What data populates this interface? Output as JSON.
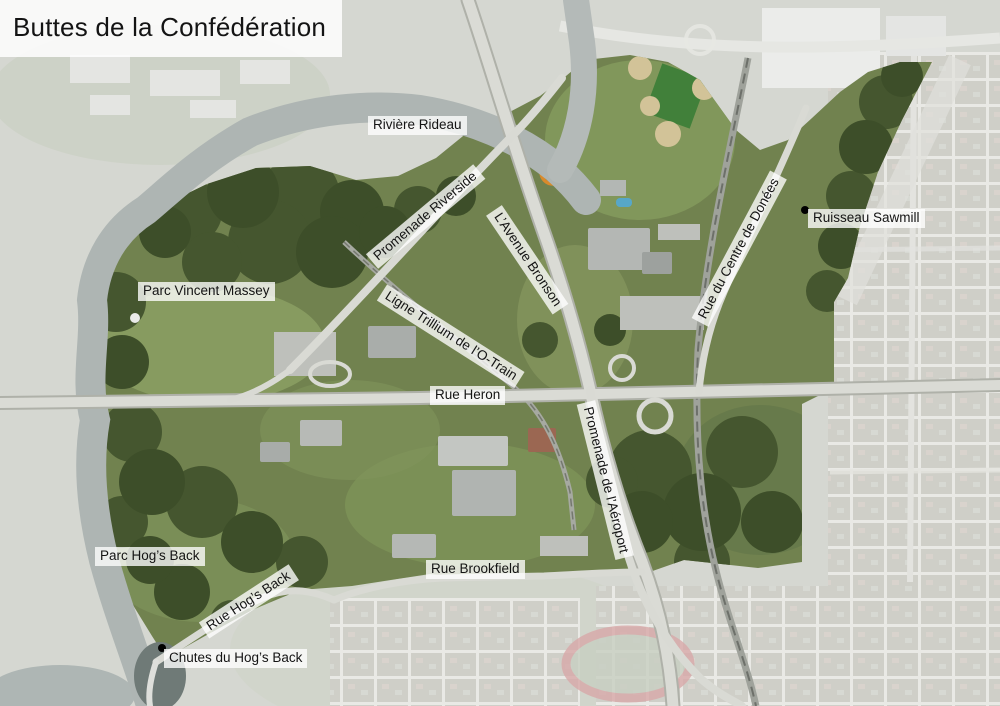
{
  "title": "Buttes de la Confédération",
  "labels": {
    "riviere_rideau": "Rivière Rideau",
    "promenade_riverside": "Promenade Riverside",
    "l_avenue_bronson": "L’Avenue Bronson",
    "rue_du_centre_de_donees": "Rue du Centre de Donées",
    "ruisseau_sawmill": "Ruisseau Sawmill",
    "parc_vincent_massey": "Parc Vincent Massey",
    "ligne_trillium": "Ligne Trillium de l’O-Train",
    "rue_heron": "Rue Heron",
    "promenade_de_l_aeroport": "Promenade de l’Aéroport",
    "parc_hogs_back": "Parc Hog’s Back",
    "rue_hogs_back": "Rue Hog’s Back",
    "rue_brookfield": "Rue Brookfield",
    "chutes_du_hogs_back": "Chutes du Hog’s Back"
  },
  "colors": {
    "highlight_region_green": "#71824f",
    "forest_dark_green": "#44562f",
    "faded_surroundings": "#d5d7d1",
    "water_gray": "#aeb5b3",
    "road_gray": "#d9dad4",
    "label_background": "rgba(255,255,255,0.78)",
    "label_text": "#141414",
    "marker_black": "#000000"
  }
}
